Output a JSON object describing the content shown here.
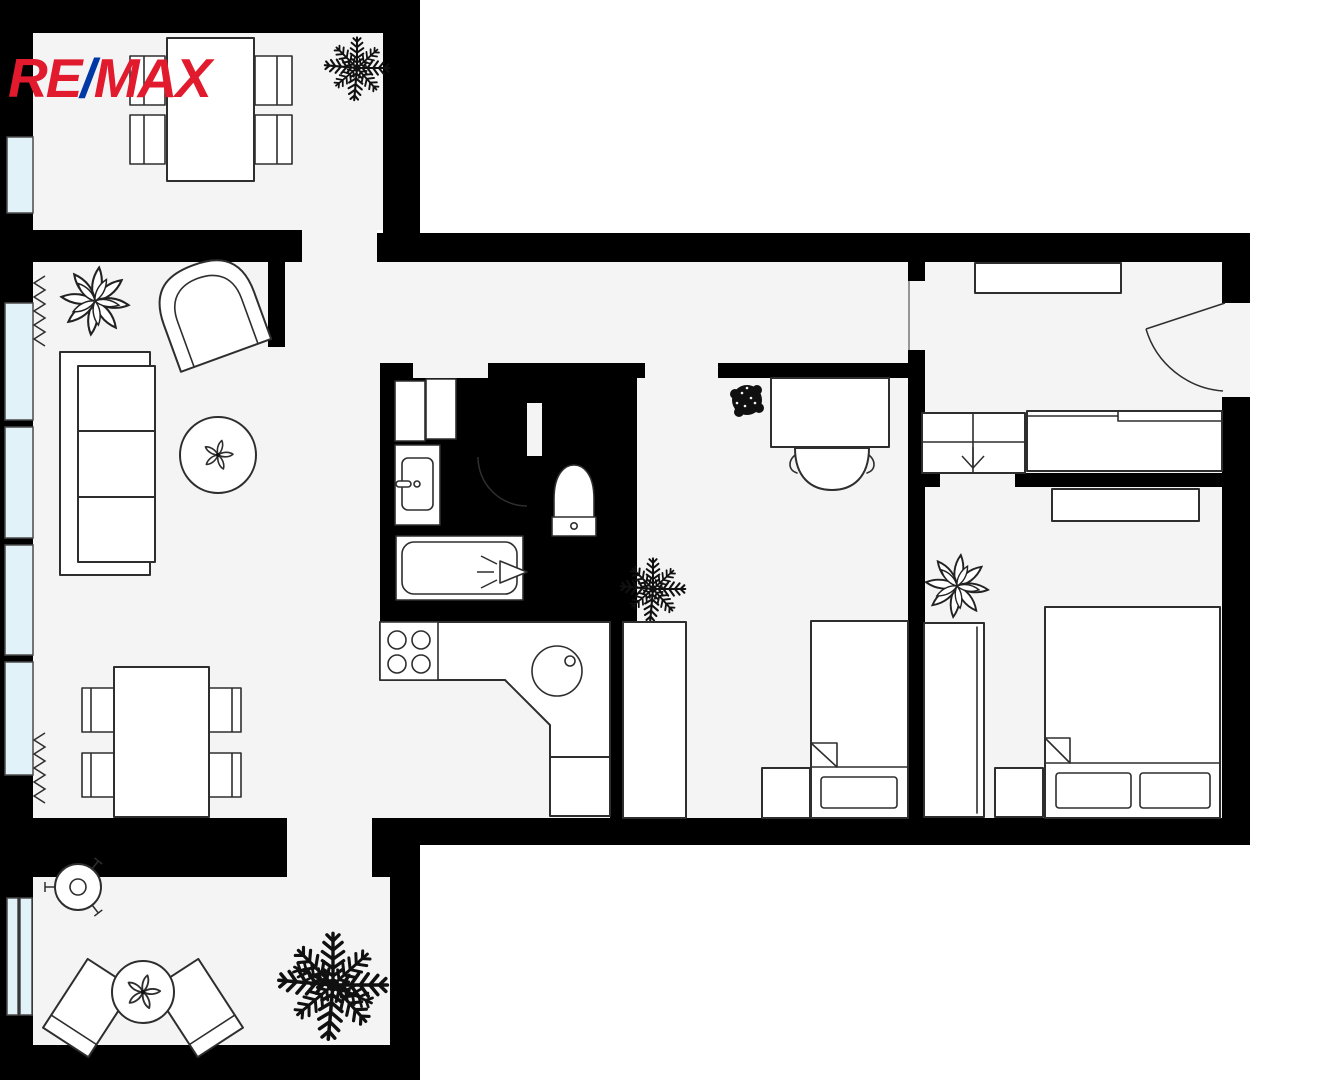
{
  "logo": {
    "re": "RE",
    "slash": "/",
    "max": "MAX"
  },
  "palette": {
    "bg": "#ffffff",
    "floor": "#f4f4f5",
    "wall": "#000000",
    "fill": "#ffffff",
    "line": "#2e2e2e",
    "window_fill": "#e1f2f9",
    "window_line": "#4a4a4a",
    "plant_dark": "#101010",
    "logo_red": "#e11b2d",
    "logo_blue": "#0039a6"
  },
  "plan": {
    "type": "apartment-floor-plan",
    "brand": "RE/MAX",
    "rooms": [
      {
        "id": "balcony-dining",
        "furniture": [
          "dining-table",
          "chair",
          "chair",
          "chair",
          "chair",
          "palm-plant"
        ]
      },
      {
        "id": "living-room",
        "furniture": [
          "curtain",
          "curtain",
          "plant",
          "armchair",
          "sofa",
          "coffee-table",
          "dining-table",
          "chair",
          "chair",
          "chair",
          "chair"
        ]
      },
      {
        "id": "kitchen",
        "furniture": [
          "counter",
          "stove",
          "sink",
          "cabinet"
        ]
      },
      {
        "id": "bathroom",
        "furniture": [
          "washing-machine",
          "cabinet",
          "sink-vanity",
          "bathtub",
          "door-arc"
        ]
      },
      {
        "id": "wc",
        "furniture": [
          "toilet"
        ]
      },
      {
        "id": "middle-bedroom",
        "furniture": [
          "desk",
          "office-chair",
          "small-plant",
          "palm-plant",
          "wardrobe",
          "nightstand",
          "single-bed"
        ]
      },
      {
        "id": "hallway",
        "furniture": [
          "shelf",
          "shoe-cabinet",
          "wardrobe",
          "entrance-door"
        ]
      },
      {
        "id": "right-bedroom",
        "furniture": [
          "shelf",
          "plant",
          "wardrobe",
          "nightstand",
          "double-bed"
        ]
      },
      {
        "id": "terrace",
        "furniture": [
          "grill",
          "round-table",
          "chair",
          "chair",
          "palm-plant"
        ]
      }
    ]
  }
}
